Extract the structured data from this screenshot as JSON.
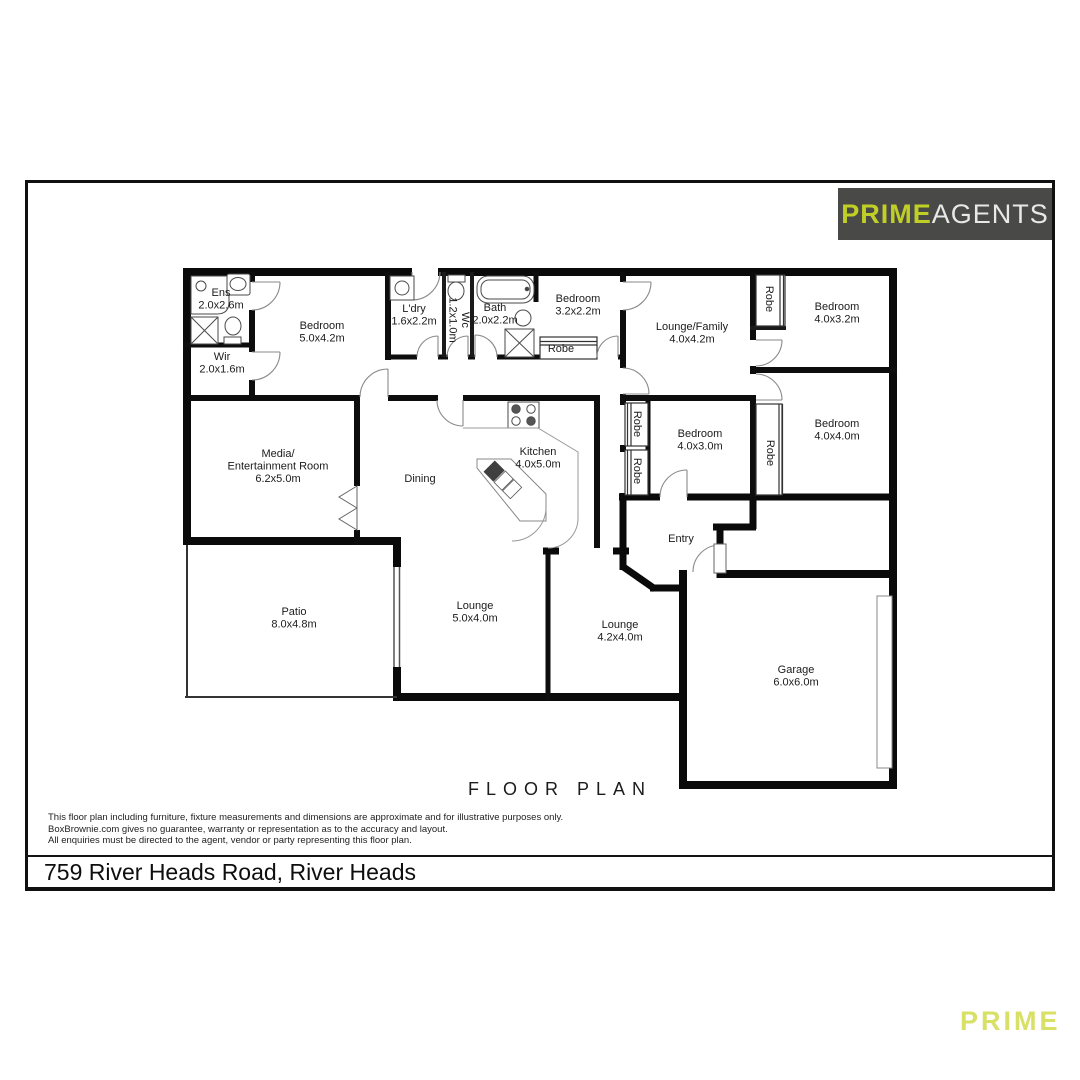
{
  "logo": {
    "prime": "PRIME",
    "agents": "AGENTS",
    "bg_color": "#494947",
    "prime_color": "#c0cf26",
    "agents_color": "#e8e8e6"
  },
  "plan": {
    "title": "FLOOR PLAN",
    "rooms": [
      {
        "id": "ens",
        "label": "Ens",
        "dims": "2.0x2.6m",
        "x": 221,
        "y": 296
      },
      {
        "id": "bedroom-1",
        "label": "Bedroom",
        "dims": "5.0x4.2m",
        "x": 322,
        "y": 329
      },
      {
        "id": "wir",
        "label": "Wir",
        "dims": "2.0x1.6m",
        "x": 222,
        "y": 360
      },
      {
        "id": "laundry",
        "label": "L'dry",
        "dims": "1.6x2.2m",
        "x": 414,
        "y": 312
      },
      {
        "id": "wc",
        "label": "Wc",
        "dims": "1.2x1.0m",
        "x": 462,
        "y": 320,
        "rotate": 90
      },
      {
        "id": "bath",
        "label": "Bath",
        "dims": "2.0x2.2m",
        "x": 495,
        "y": 311
      },
      {
        "id": "bedroom-2",
        "label": "Bedroom",
        "dims": "3.2x2.2m",
        "x": 578,
        "y": 302
      },
      {
        "id": "robe-hall",
        "label": "Robe",
        "x": 561,
        "y": 352
      },
      {
        "id": "lounge-family",
        "label": "Lounge/Family",
        "dims": "4.0x4.2m",
        "x": 692,
        "y": 330
      },
      {
        "id": "robe-bed3",
        "label": "Robe",
        "x": 766,
        "y": 299,
        "rotate": 90
      },
      {
        "id": "bedroom-3",
        "label": "Bedroom",
        "dims": "4.0x3.2m",
        "x": 837,
        "y": 310
      },
      {
        "id": "media",
        "label": "Media/",
        "line2": "Entertainment Room",
        "dims": "6.2x5.0m",
        "x": 278,
        "y": 457
      },
      {
        "id": "dining",
        "label": "Dining",
        "x": 420,
        "y": 482
      },
      {
        "id": "kitchen",
        "label": "Kitchen",
        "dims": "4.0x5.0m",
        "x": 538,
        "y": 455
      },
      {
        "id": "robe-hall-2",
        "label": "Robe",
        "x": 634,
        "y": 424,
        "rotate": 90
      },
      {
        "id": "robe-hall-3",
        "label": "Robe",
        "x": 634,
        "y": 471,
        "rotate": 90
      },
      {
        "id": "bedroom-4",
        "label": "Bedroom",
        "dims": "4.0x3.0m",
        "x": 700,
        "y": 437
      },
      {
        "id": "robe-bed5",
        "label": "Robe",
        "x": 767,
        "y": 453,
        "rotate": 90
      },
      {
        "id": "bedroom-5",
        "label": "Bedroom",
        "dims": "4.0x4.0m",
        "x": 837,
        "y": 427
      },
      {
        "id": "entry",
        "label": "Entry",
        "x": 681,
        "y": 542
      },
      {
        "id": "patio",
        "label": "Patio",
        "dims": "8.0x4.8m",
        "x": 294,
        "y": 615
      },
      {
        "id": "lounge-1",
        "label": "Lounge",
        "dims": "5.0x4.0m",
        "x": 475,
        "y": 609
      },
      {
        "id": "lounge-2",
        "label": "Lounge",
        "dims": "4.2x4.0m",
        "x": 620,
        "y": 628
      },
      {
        "id": "garage",
        "label": "Garage",
        "dims": "6.0x6.0m",
        "x": 796,
        "y": 673
      }
    ],
    "fixtures": [
      "shower-icon",
      "shower-tray-icon",
      "basin-icon",
      "toilet-icon",
      "bathtub-icon",
      "laundry-tub-icon",
      "stove-icon",
      "kitchen-island-sink-icon",
      "garage-door",
      "window",
      "door-swing"
    ]
  },
  "disclaimer": {
    "line1": "This floor plan including furniture, fixture measurements and dimensions are approximate and for illustrative purposes only.",
    "line2": "BoxBrownie.com gives no guarantee, warranty or representation as to the accuracy and layout.",
    "line3": "All enquiries must be directed to the agent, vendor or party representing this floor plan."
  },
  "address": "759 River Heads Road, River Heads",
  "watermark": {
    "text": "PRIME",
    "color": "#d8e065"
  }
}
